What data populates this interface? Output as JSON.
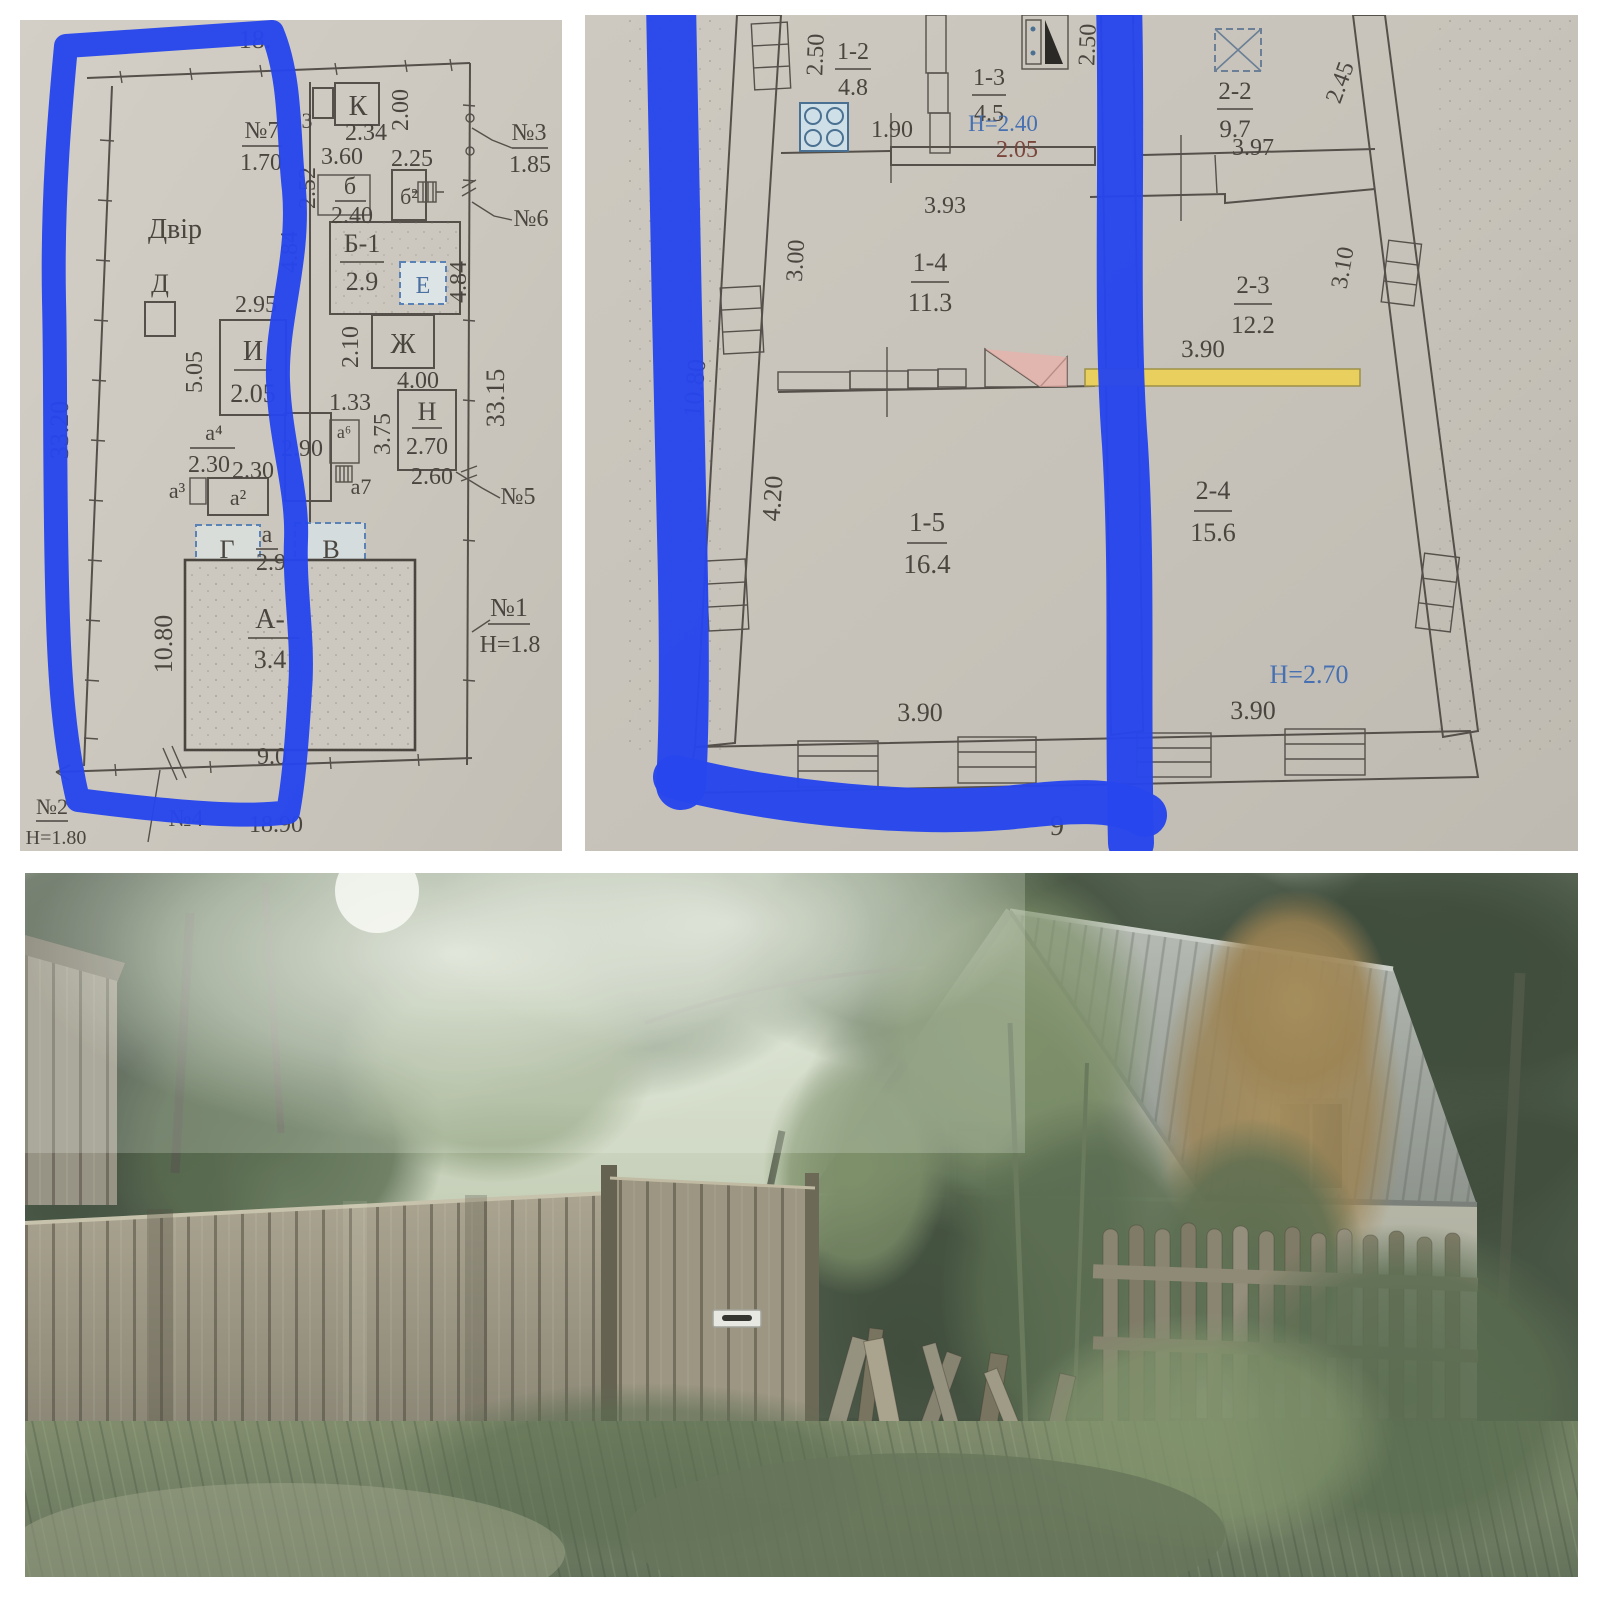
{
  "collage": {
    "background": "#ffffff",
    "layout": "two technical floor plans on top, house photo below"
  },
  "annotation": {
    "marker_color": "#2746ec",
    "style": "hand-drawn blue highlighter strokes outlining the left parts of both plans"
  },
  "palette": {
    "paper": "#cac6bd",
    "plan_line": "#55504a",
    "fill_pink": "#eeafa7",
    "fill_yellow": "#e9d05e",
    "fill_light": "#d3d6cd",
    "dashed_blue": "#5b82b5",
    "height_text_blue": "#4670b2",
    "marker_blue": "#2746ec"
  },
  "left_plan": {
    "kind": "site plan",
    "labels": {
      "dim_top": "18.",
      "frag3": "3",
      "k": "К",
      "dim_234": "2.34",
      "dim_200": "2.00",
      "dim_360": "3.60",
      "dim_225": "2.25",
      "no7": "№7",
      "no7_h": "1.70",
      "b": "б",
      "b_h": "2.40",
      "b2": "б²",
      "b1": "Б-1",
      "b1_h": "2.9",
      "e": "Е",
      "dim_484a": "4.84",
      "dim_484b": "4.84",
      "dim_252": "2.52",
      "dvir": "Двір",
      "d": "Д",
      "dim_295": "2.95",
      "i": "И",
      "i_h": "2.05",
      "dim_505": "5.05",
      "dim_210": "2.10",
      "zh": "Ж",
      "dim_400": "4.00",
      "dim_133": "1.33",
      "n": "Н",
      "n_h": "2.70",
      "dim_375": "3.75",
      "dim_3315": "33.15",
      "dim_290": "2.90",
      "a6": "а⁶",
      "a7": "а7",
      "a4": "а⁴",
      "a4_h": "2.30",
      "dim_230": "2.30",
      "a3": "а³",
      "a2": "а²",
      "dim_260": "2.60",
      "no5": "№5",
      "g": "Г",
      "a_small": "а",
      "a_small_h": "2.9",
      "v": "В",
      "a_bld": "А-",
      "a_bld_h": "3.4",
      "dim_1080": "10.80",
      "dim_90": "9.0",
      "dim_3320": "33.20",
      "no3": "№3",
      "no3_h": "1.85",
      "no6": "№6",
      "no1": "№1",
      "no1_h": "Н=1.8",
      "no4": "№4",
      "dim_1890": "18.90",
      "no2": "№2",
      "no2_h": "Н=1.80"
    }
  },
  "right_plan": {
    "kind": "floor plan, two dwelling sections",
    "labels": {
      "r12": "1-2",
      "r12_a": "4.8",
      "r13": "1-3",
      "r13_a": "4.5",
      "h240": "Н=2.40",
      "dim_205": "2.05",
      "dim_190": "1.90",
      "dim_250a": "2.50",
      "dim_250b": "2.50",
      "dim_393": "3.93",
      "r14": "1-4",
      "r14_a": "11.3",
      "dim_300": "3.00",
      "dim_1080": "10.80",
      "dim_420": "4.20",
      "r15": "1-5",
      "r15_a": "16.4",
      "dim_390a": "3.90",
      "dim_9": "9",
      "r22": "2-2",
      "r22_a": "9.7",
      "dim_245": "2.45",
      "dim_397": "3.97",
      "r23": "2-3",
      "r23_a": "12.2",
      "dim_310": "3.10",
      "dim_390b": "3.90",
      "r24": "2-4",
      "r24_a": "15.6",
      "h270": "Н=2.70",
      "dim_390c": "3.90"
    }
  },
  "photo": {
    "scene": "single-storey house with grey corrugated roof behind a weathered wooden plank fence and picket fence, overgrown with trees, bushes and tall grass; white mail slot on the gate"
  }
}
